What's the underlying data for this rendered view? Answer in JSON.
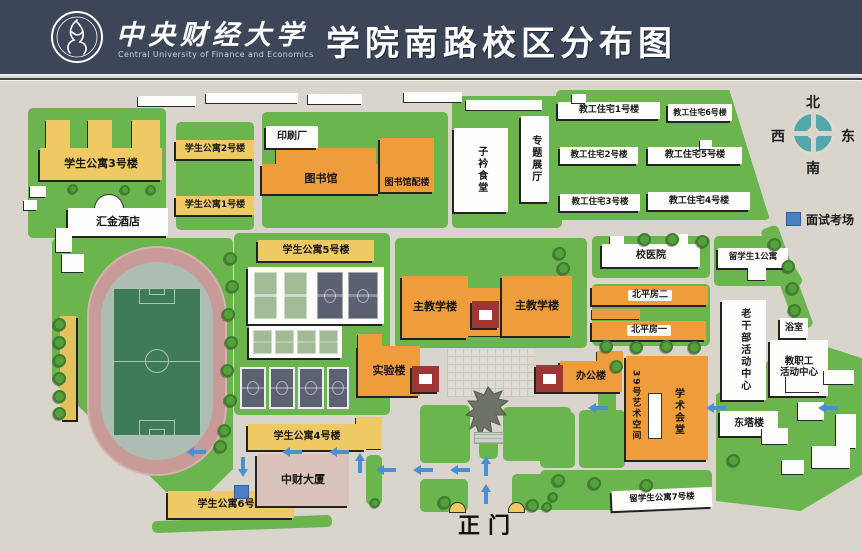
{
  "header": {
    "university_zh": "中央财经大学",
    "university_en": "Central University of Finance and Economics",
    "title": "学院南路校区分布图"
  },
  "compass": {
    "north": "北",
    "south": "南",
    "east": "东",
    "west": "西"
  },
  "legend": {
    "interview": "面试考场"
  },
  "gate_label": "正门",
  "buildings": {
    "apt1": "学生公寓1号楼",
    "apt2": "学生公寓2号楼",
    "apt3": "学生公寓3号楼",
    "apt4": "学生公寓4号楼",
    "apt5": "学生公寓5号楼",
    "apt6": "学生公寓6号楼",
    "hotel": "汇金酒店",
    "print_shop": "印刷厂",
    "library": "图书馆",
    "library_annex": "图书馆配楼",
    "canteen": "子衿食堂",
    "exhibit_hall": "专题展厅",
    "fac1": "教工住宅1号楼",
    "fac2": "教工住宅2号楼",
    "fac3": "教工住宅3号楼",
    "fac4": "教工住宅4号楼",
    "fac5": "教工住宅5号楼",
    "fac6": "教工住宅6号楼",
    "main_teaching_west": "主教学楼",
    "main_teaching_east": "主教学楼",
    "lab": "实验楼",
    "office": "办公楼",
    "hospital": "校医院",
    "intl_apt1": "留学生1公寓",
    "beiping2": "北平房二",
    "beiping1": "北平房一",
    "veteran_center": "老干部活动中心",
    "bathhouse": "浴室",
    "staff_center_line1": "教职工",
    "staff_center_line2": "活动中心",
    "art_space39": "39号艺术空间",
    "academic_hall": "学术会堂",
    "east_tower": "东塔楼",
    "intl_apt7": "留学生公寓7号楼",
    "cufe_tower": "中财大厦"
  },
  "colors": {
    "header_bg": "#3d4659",
    "map_bg": "#d9d5cc",
    "green": "#6ab54d",
    "yellow": "#eec964",
    "orange": "#ef9d3b",
    "red_tower": "#9e3733",
    "track": "#c89a98",
    "pitch": "#3f7a5b",
    "court_dark": "#5c6172",
    "court_light": "#a2bb97",
    "tower_tan": "#d9c3bb",
    "arrow_blue": "#4a8fd3",
    "legend_blue": "#4a7fc4",
    "compass_teal": "#53a8ac"
  }
}
